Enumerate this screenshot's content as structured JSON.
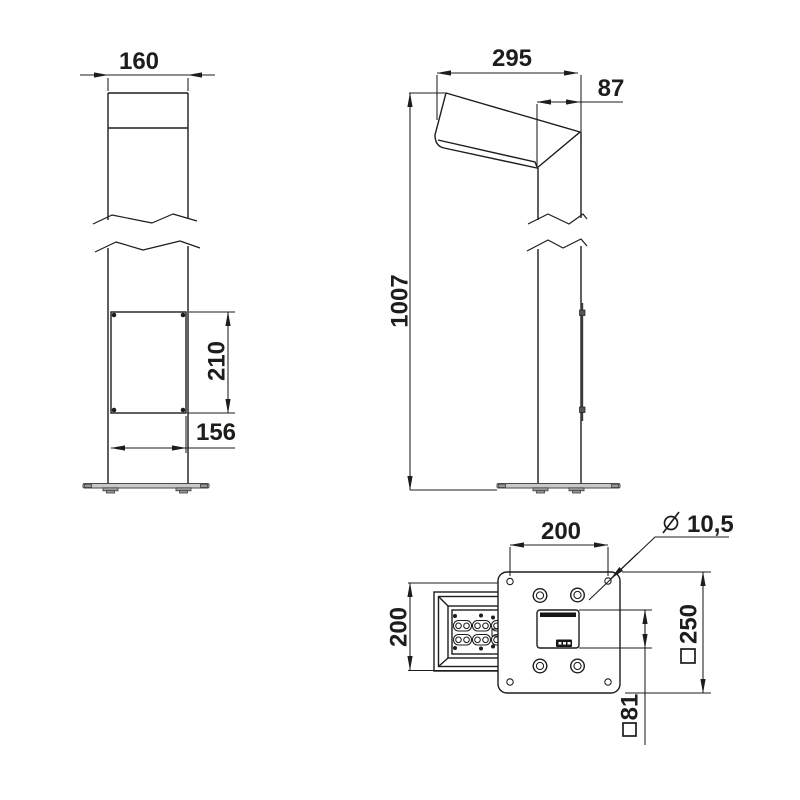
{
  "colors": {
    "line": "#1d1d1b",
    "metal_gray": "#c9c9c9",
    "background": "#ffffff"
  },
  "symbols": {
    "diameter": "⌀",
    "square": "□"
  },
  "views": {
    "front": {
      "pole_width": "160",
      "door_height": "210",
      "door_width": "156"
    },
    "side": {
      "head_length": "295",
      "pole_depth": "87",
      "total_height": "1007"
    },
    "bottom": {
      "mounting_hole_spacing": "200",
      "mounting_hole_diameter": "10,5",
      "head_width": "200",
      "base_plate_size": "250",
      "cable_opening_size": "81"
    }
  }
}
